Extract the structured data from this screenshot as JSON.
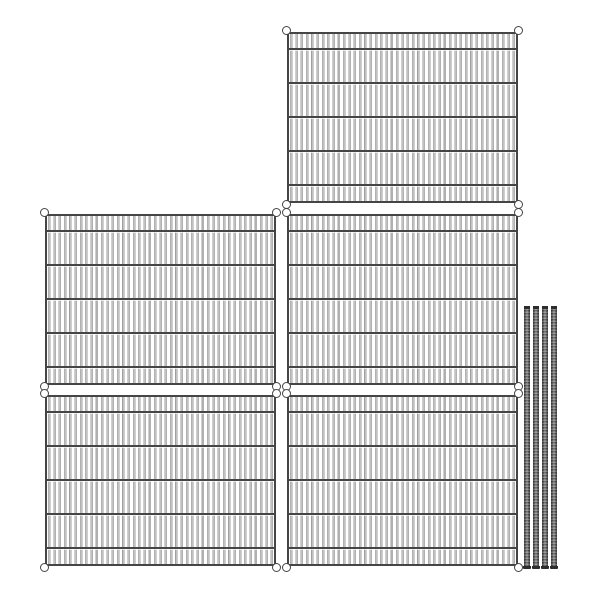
{
  "figure": {
    "type": "product-image",
    "description": "Wire shelving kit parts on a white background: five rectangular wire mesh shelf panels arranged in an L shape and four metal shelving posts standing at the lower right",
    "shelf_count": 5,
    "post_count": 4,
    "background_color": "#ffffff",
    "colors": {
      "shelf_frame": "#454545",
      "shelf_wire": "#c2c2c2",
      "corner_ring_fill": "#ffffff",
      "post_dark": "#3b3b3b",
      "post_mid": "#5a5a5a",
      "post_highlight": "#9a9a9a",
      "post_cap": "#2d2d2d"
    },
    "shelves": [
      {
        "id": "shelf-top",
        "x": 287,
        "y": 32,
        "width": 231,
        "height": 171
      },
      {
        "id": "shelf-middle-left",
        "x": 45,
        "y": 214,
        "width": 231,
        "height": 171
      },
      {
        "id": "shelf-middle-right",
        "x": 287,
        "y": 214,
        "width": 231,
        "height": 171
      },
      {
        "id": "shelf-bottom-left",
        "x": 45,
        "y": 395,
        "width": 231,
        "height": 171
      },
      {
        "id": "shelf-bottom-right",
        "x": 287,
        "y": 395,
        "width": 231,
        "height": 171
      }
    ],
    "shelf_structure": {
      "border_px": 2,
      "crossbar_offsets_px": [
        16,
        50,
        84,
        118,
        152
      ],
      "wire_pitch_px": 5.3,
      "wire_width_px": 2,
      "corner_ring_diameter_px": 9
    },
    "posts": {
      "x_positions": [
        524,
        533,
        542,
        551
      ],
      "y": 306,
      "width": 6,
      "height": 263
    }
  }
}
